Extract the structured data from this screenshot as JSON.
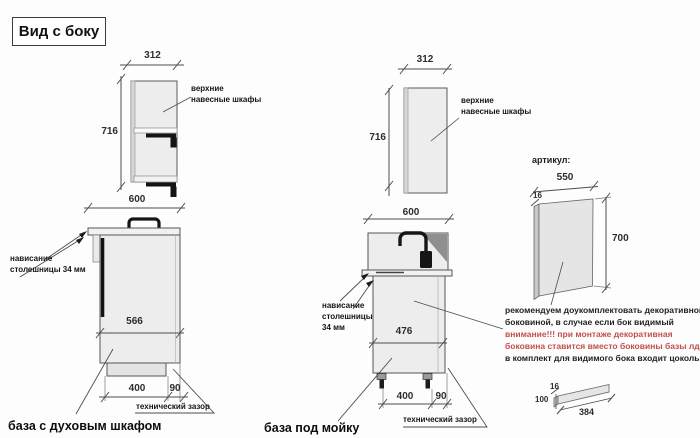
{
  "title": "Вид с боку",
  "colors": {
    "red_text": "#c0504d",
    "line": "#4d4d4d"
  },
  "left_view": {
    "caption": "база с духовым шкафом",
    "upper": {
      "width": "312",
      "height": "716",
      "label": "верхние навесные шкафы"
    },
    "base": {
      "width": "600",
      "inner_depth": "566",
      "overhang_line1": "нависание",
      "overhang_line2": "столешницы 34 мм",
      "plinth_width": "400",
      "tech_gap": "90",
      "tech_gap_label": "технический зазор"
    }
  },
  "middle_view": {
    "caption": "база под мойку",
    "upper": {
      "width": "312",
      "height": "716",
      "label": "верхние навесные шкафы"
    },
    "base": {
      "width": "600",
      "inner_depth": "476",
      "overhang_line1": "нависание",
      "overhang_line2": "столешницы",
      "overhang_line3": "34 мм",
      "plinth_width": "400",
      "tech_gap": "90",
      "tech_gap_label": "технический зазор"
    }
  },
  "right_section": {
    "heading": "артикул:",
    "decor_panel": {
      "width": "550",
      "thickness": "16",
      "height": "700"
    },
    "note": {
      "line1": "рекомендуем доукомплектовать декоративной",
      "line2": "боковиной, в случае если бок видимый",
      "line3": "внимание!!! при монтаже декоративная",
      "line4": "боковина ставится вместо боковины базы лдсп",
      "line5": "в комплект для видимого бока входит цоколь:"
    },
    "plinth": {
      "thickness": "16",
      "height": "100",
      "length": "384"
    }
  }
}
